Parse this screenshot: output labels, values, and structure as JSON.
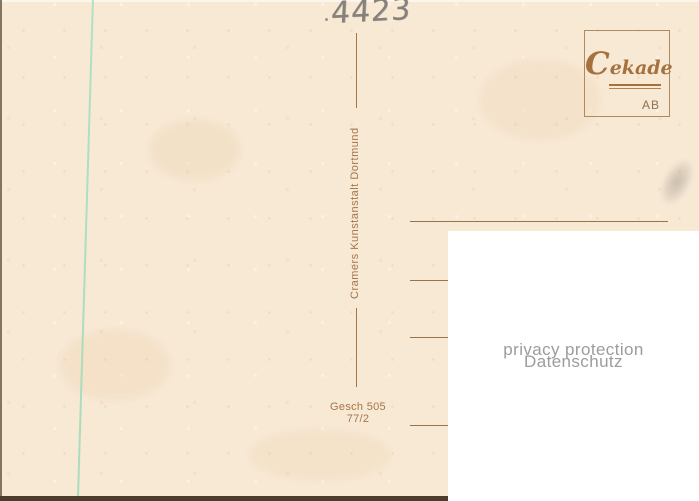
{
  "card": {
    "handwritten_number": "4423",
    "publisher": "Cramers Kunstanstalt Dortmund",
    "order_code": "Gesch 505",
    "order_number": "77/2",
    "logo": {
      "brand": "Cekade",
      "initials": "AB"
    },
    "privacy": {
      "line1": "privacy protection",
      "line2": "Datenschutz"
    },
    "colors": {
      "card_background": "#f8e9d5",
      "print_brown": "#a5764a",
      "logo_brown": "#a5713f",
      "pencil_gray": "#86817a",
      "teal_sorting_line": "#9ad8b8",
      "privacy_text_gray": "#9c9c9c",
      "overlay_white": "#ffffff"
    }
  }
}
